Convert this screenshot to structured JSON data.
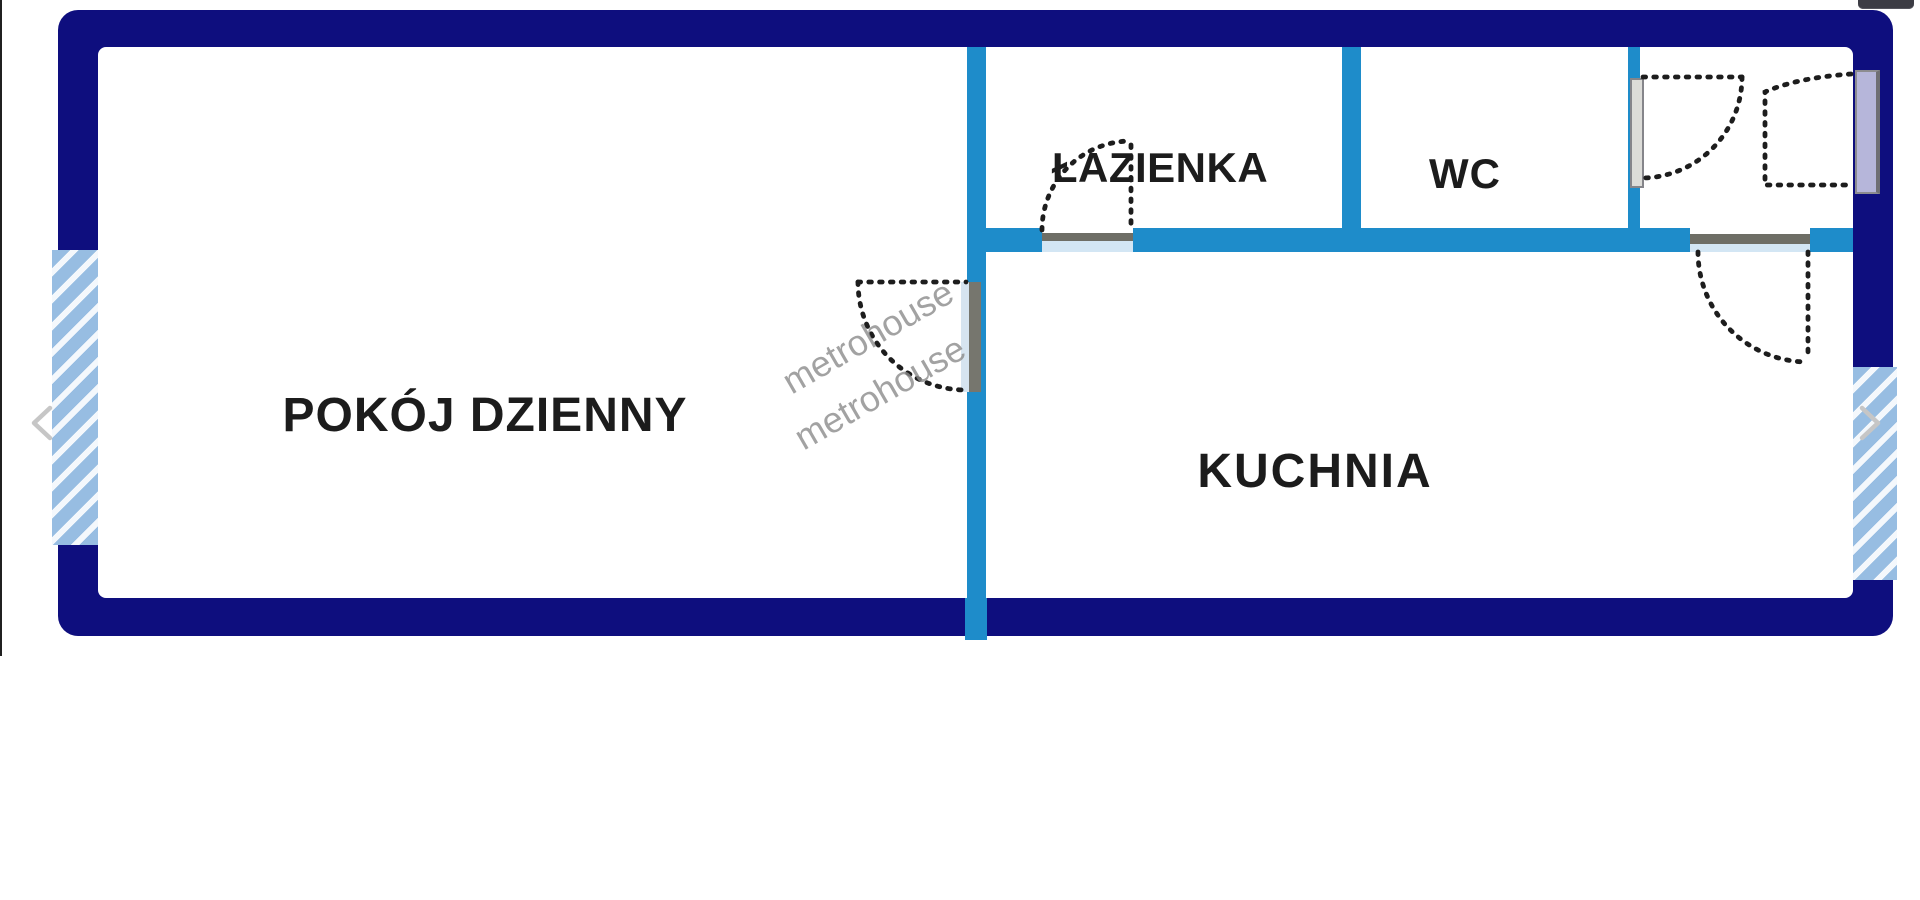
{
  "viewer": {
    "background": "#ffffff",
    "photo_edge_line_color": "#202020",
    "nav": {
      "prev_icon": "chevron-left",
      "next_icon": "chevron-right",
      "chevron_color": "#c6c6c6"
    },
    "top_right_button": {
      "icon": "collapsed-toolbar-control",
      "color": "#3c3c44"
    }
  },
  "floor_plan": {
    "colors": {
      "outer_wall": "#0e0e7e",
      "inner_wall": "#1e8cca",
      "window_hatch": "#97bde2",
      "label_text": "#1c1c1c",
      "watermark": "#8c8c8c",
      "door_dash": "#1d1d1d",
      "sill_gray": "#6e6e66",
      "sill_blue": "#d3e6f4",
      "entrance_door_leaf": "#b6b6da"
    },
    "rooms": [
      {
        "name": "living-room",
        "label": "POKÓJ DZIENNY"
      },
      {
        "name": "kitchen",
        "label": "KUCHNIA"
      },
      {
        "name": "bathroom",
        "label": "ŁAZIENKA"
      },
      {
        "name": "wc",
        "label": "WC"
      }
    ],
    "watermark": {
      "text": "metrohouse"
    },
    "doors": [
      {
        "name": "living-room-door"
      },
      {
        "name": "bathroom-door"
      },
      {
        "name": "wc-hall-door"
      },
      {
        "name": "entrance-door"
      },
      {
        "name": "kitchen-door"
      }
    ],
    "windows": [
      {
        "name": "left-window"
      },
      {
        "name": "right-window"
      }
    ]
  }
}
